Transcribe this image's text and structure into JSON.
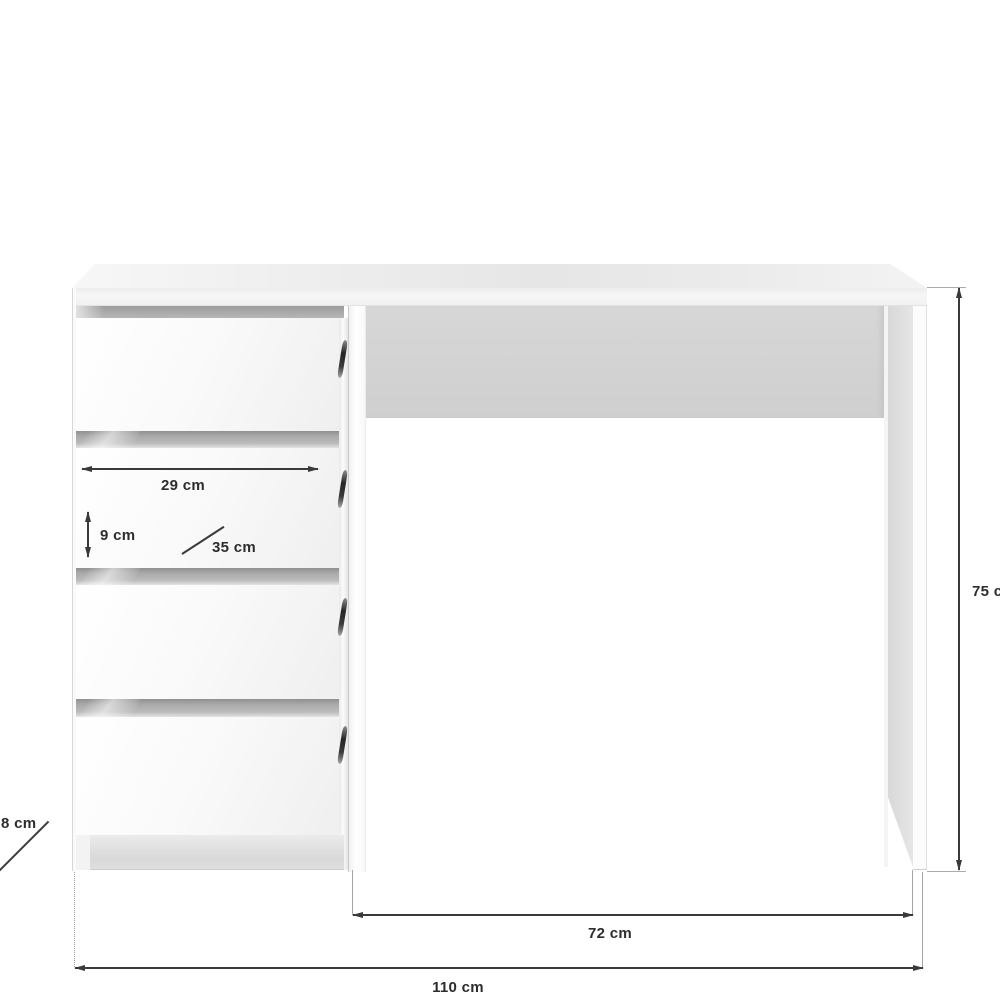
{
  "diagram": {
    "kind": "product dimension diagram",
    "subject": "white desk with four drawers and open kneehole",
    "background": "#ffffff",
    "dimension_line_color": "#3a3a3a",
    "label_color": "#2d2d2d",
    "unit": "cm",
    "dimensions": {
      "drawer_inner_width": {
        "label": "29 cm",
        "value": 29
      },
      "drawer_front_height": {
        "label": "9 cm",
        "value": 9
      },
      "drawer_depth": {
        "label": "35 cm",
        "value": 35
      },
      "desk_height": {
        "label": "75 cm",
        "value": 75
      },
      "kneehole_width": {
        "label": "72 cm",
        "value": 72
      },
      "overall_width": {
        "label": "110 cm",
        "value": 110
      },
      "partial_left_dim": {
        "label": "8 cm",
        "value": 8
      }
    }
  }
}
